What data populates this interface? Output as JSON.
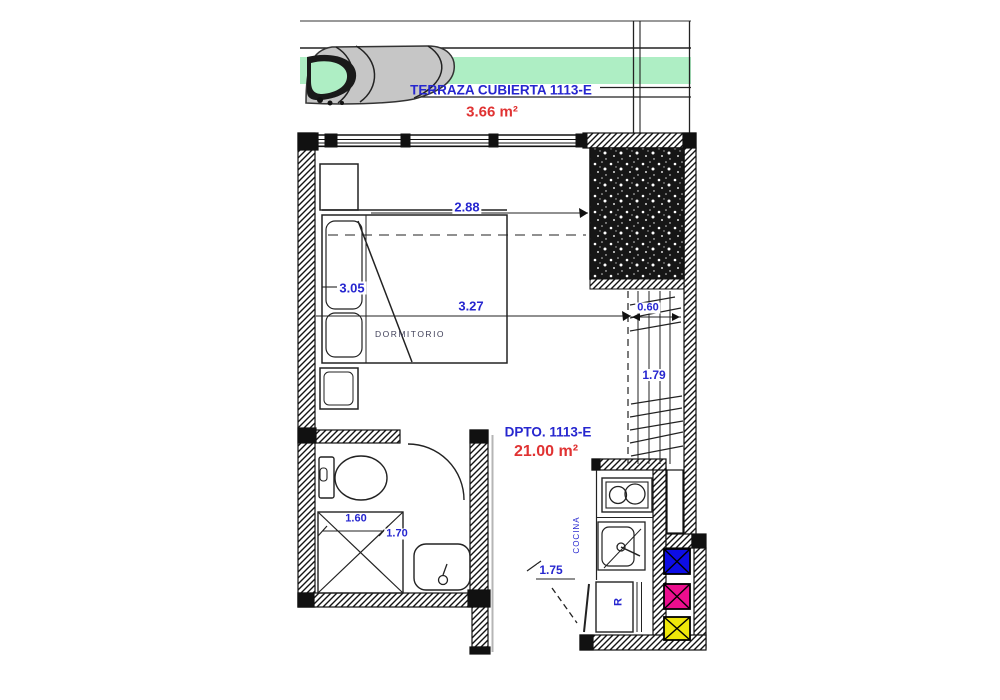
{
  "plan": {
    "terrace": {
      "label": "TERRAZA CUBIERTA 1113-E",
      "area": "3.66 m²"
    },
    "unit": {
      "label": "DPTO. 1113-E",
      "area": "21.00 m²"
    },
    "rooms": {
      "bedroom": "DORMITORIO",
      "kitchen": "COCINA",
      "fridge": "R"
    },
    "dimensions": {
      "bed_width": "2.88",
      "bed_length": "3.05",
      "bedroom_length": "3.27",
      "closet_width": "0.60",
      "closet_length": "1.79",
      "bath_width": "1.60",
      "bath_length": "1.70",
      "entry_width": "1.75"
    },
    "colors": {
      "label_blue": "#2626cf",
      "area_red": "#e03232",
      "terrace_green": "#aeeec4",
      "duct_blue": "#0d0de6",
      "duct_magenta": "#ec0e8e",
      "duct_yellow": "#efe70a"
    }
  }
}
